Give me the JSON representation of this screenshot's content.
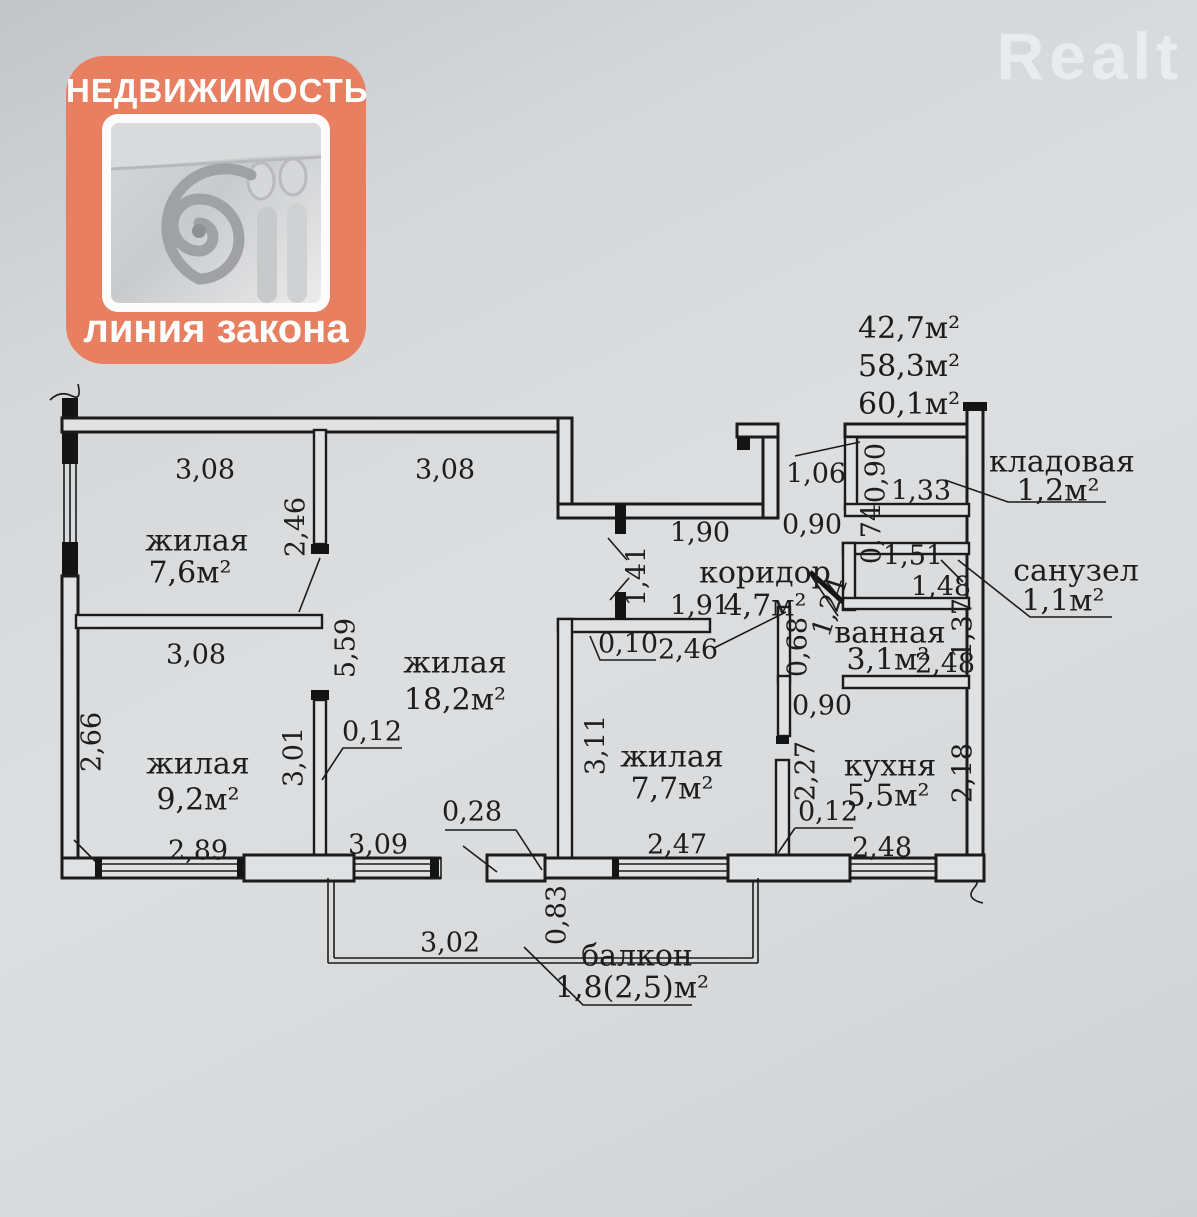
{
  "watermark": "Realt",
  "logo": {
    "title": "НЕДВИЖИМОСТЬ",
    "subtitle": "линия закона",
    "icon": "column-capital-volute"
  },
  "totals": {
    "t1": "42,7м²",
    "t2": "58,3м²",
    "t3": "60,1м²"
  },
  "rooms": {
    "living1": {
      "name": "жилая",
      "area": "7,6м²"
    },
    "living2": {
      "name": "жилая",
      "area": "9,2м²"
    },
    "living3": {
      "name": "жилая",
      "area": "18,2м²"
    },
    "living4": {
      "name": "жилая",
      "area": "7,7м²"
    },
    "corridor": {
      "name": "коридор",
      "area": "4,7м²"
    },
    "storage": {
      "name": "кладовая",
      "area": "1,2м²"
    },
    "wc": {
      "name": "санузел",
      "area": "1,1м²"
    },
    "bath": {
      "name": "ванная",
      "area": "3,1м²"
    },
    "kitchen": {
      "name": "кухня",
      "area": "5,5м²"
    },
    "balcony": {
      "name": "балкон",
      "area": "1,8(2,5)м²"
    }
  },
  "dims": {
    "d01": "3,08",
    "d02": "3,08",
    "d03": "2,46",
    "d04": "3,08",
    "d05": "2,66",
    "d06": "2,89",
    "d07": "5,59",
    "d08": "3,01",
    "d09": "0,12",
    "d10": "0,28",
    "d11": "3,09",
    "d12": "3,11",
    "d13": "2,47",
    "d14": "1,90",
    "d15": "1,41",
    "d16": "1,91",
    "d17": "2,46",
    "d18": "0,10",
    "d19": "1,06",
    "d20": "0,90",
    "d21": "0,90",
    "d22": "1,33",
    "d23": "0,74",
    "d24": "1,51",
    "d25": "1,48",
    "d26": "1,24",
    "d27": "0,68",
    "d28": "1,37",
    "d29": "2,48",
    "d30": "0,90",
    "d31": "2,27",
    "d32": "0,12",
    "d33": "2,48",
    "d34": "2,18",
    "d35": "3,02",
    "d36": "0,83"
  }
}
